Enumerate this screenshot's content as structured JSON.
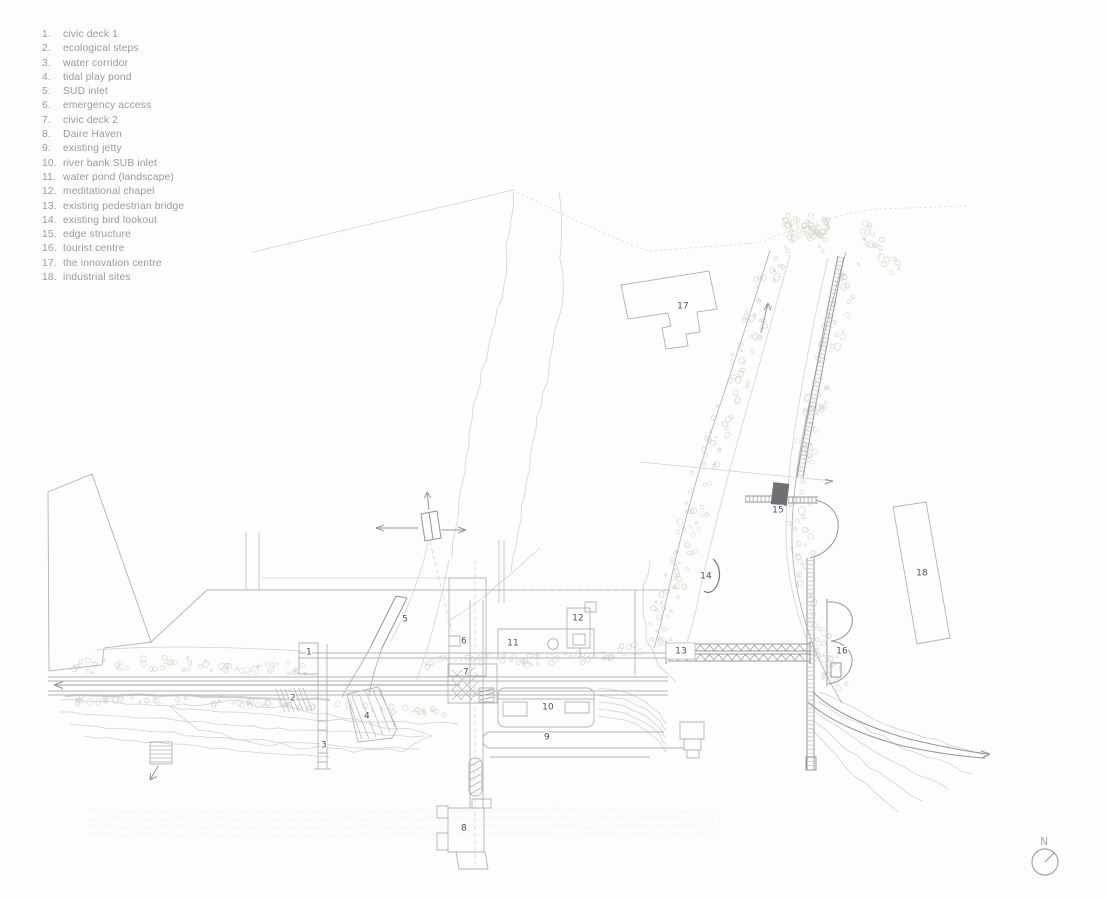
{
  "legend": {
    "items": [
      {
        "num": "1.",
        "label": "civic deck 1"
      },
      {
        "num": "2.",
        "label": "ecological steps"
      },
      {
        "num": "3.",
        "label": "water corridor"
      },
      {
        "num": "4.",
        "label": "tidal play pond"
      },
      {
        "num": "5.",
        "label": "SUD inlet"
      },
      {
        "num": "6.",
        "label": "emergency access"
      },
      {
        "num": "7.",
        "label": "civic deck 2"
      },
      {
        "num": "8.",
        "label": "Daire Haven"
      },
      {
        "num": "9.",
        "label": "existing jetty"
      },
      {
        "num": "10.",
        "label": "river bank SUB inlet"
      },
      {
        "num": "11.",
        "label": "water pond (landscape)"
      },
      {
        "num": "12.",
        "label": "meditational chapel"
      },
      {
        "num": "13.",
        "label": "existing pedestrian bridge"
      },
      {
        "num": "14.",
        "label": "existing bird lookout"
      },
      {
        "num": "15.",
        "label": "edge structure"
      },
      {
        "num": "16.",
        "label": "tourist centre"
      },
      {
        "num": "17.",
        "label": "the innovation centre"
      },
      {
        "num": "18.",
        "label": "industrial sites"
      }
    ]
  },
  "plan": {
    "marker_labels": [
      "1",
      "2",
      "3",
      "4",
      "5",
      "6",
      "7",
      "8",
      "9",
      "10",
      "11",
      "12",
      "13",
      "14",
      "15",
      "16",
      "17",
      "18"
    ],
    "north_label": "N"
  },
  "colors": {
    "paper": "#fdfdfb",
    "legend_text": "#9a9a9a",
    "marker_text": "#4e4f54",
    "line_faint": "#cfd0d5",
    "line_light": "#b1b3ba",
    "line_medium": "#94969c",
    "line_dark": "#76777d",
    "vegetation": "#b5b9af",
    "vegetation_light": "#c7cac1",
    "north": "#a2a3a7",
    "structure_fill": "#6f7076"
  }
}
